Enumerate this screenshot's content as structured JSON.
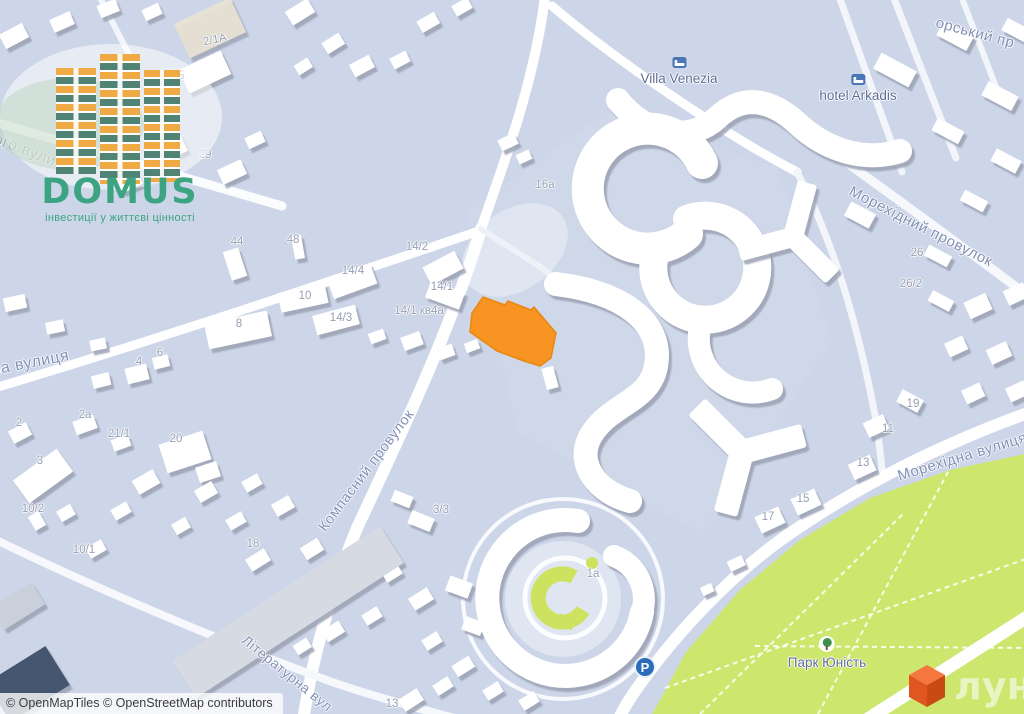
{
  "watermark": {
    "brand": "DOMUS",
    "tagline": "інвестиції у життєві цінності"
  },
  "attribution": "© OpenMapTiles © OpenStreetMap contributors",
  "lun_logo": {
    "text": "лун"
  },
  "parking": {
    "letter": "P"
  },
  "streets": [
    {
      "id": "vulytsia-partial-top-left",
      "text": "ого вулиця"
    },
    {
      "id": "vulytsia-partial-left",
      "text": "на вулиця"
    },
    {
      "id": "kompasnyi-provulok",
      "text": "Компасний провулок"
    },
    {
      "id": "morekhidnyi-provulok",
      "text": "Морехідний провулок"
    },
    {
      "id": "morekhidna-vulytsia",
      "text": "Морехідна вулиця"
    },
    {
      "id": "literaturna-vulytsia",
      "text": "Літературна вул"
    },
    {
      "id": "provulok-partial-top-right",
      "text": "орський пр"
    }
  ],
  "places": [
    {
      "id": "villa-venezia",
      "text": "Villa Venezia",
      "icon": "bed-icon"
    },
    {
      "id": "hotel-arkadis",
      "text": "hotel Arkadis",
      "icon": "bed-icon"
    },
    {
      "id": "park-yunist",
      "text": "Парк Юність",
      "icon": "tree-icon"
    }
  ],
  "house_numbers": [
    "2/1А",
    "2/1Б",
    "29",
    "44",
    "48",
    "14/2",
    "14/4",
    "14/1",
    "10",
    "8",
    "14/3",
    "14/1 кв4а",
    "16а",
    "4",
    "6",
    "2",
    "2а",
    "21/1",
    "20",
    "3",
    "10/2",
    "10/1",
    "18",
    "3/3",
    "1а",
    "13",
    "26",
    "26/2",
    "19",
    "11",
    "13",
    "15",
    "17"
  ],
  "colors": {
    "map_background": "#ccd6e8",
    "building": "#ffffff",
    "building_shadow": "#9aa1b2",
    "park_green": "#cde76e",
    "selection_orange": "#f79422",
    "road_white": "#ffffff",
    "street_label": "#8290b4",
    "number_label": "#96a0b3",
    "place_label": "#5d6f92",
    "domus_green": "#38a37f",
    "domus_amber": "#f0a93f",
    "domus_teal": "#4c8170",
    "lun_orange": "#e05620",
    "parking_blue": "#2a6ebb",
    "hotel_icon_blue": "#4b76b6"
  }
}
